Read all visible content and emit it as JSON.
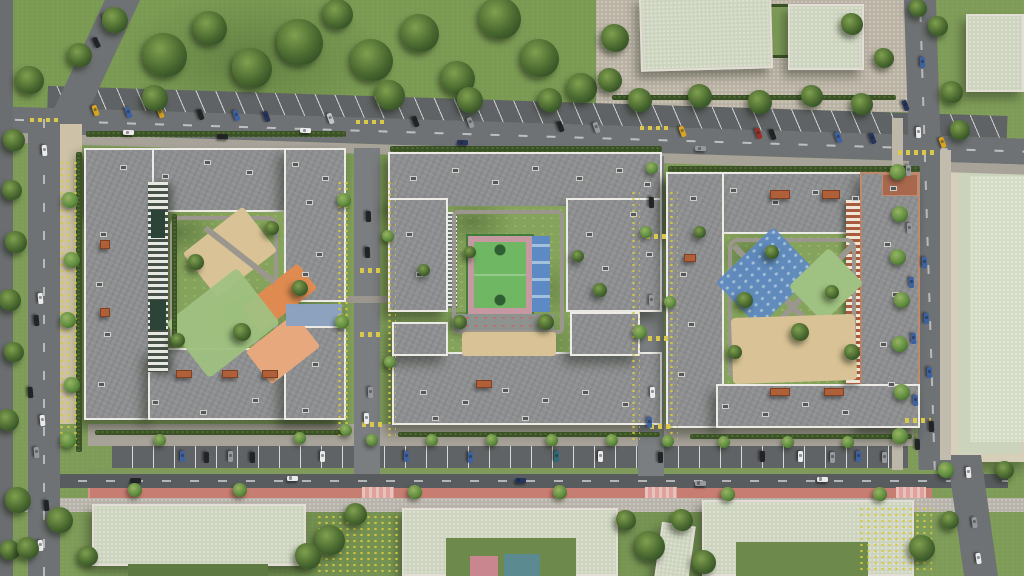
{
  "meta": {
    "title": "Aerial render of residential complex with three courtyard apartment blocks, playgrounds, sports court, roads and parking",
    "width": 1024,
    "height": 576
  },
  "palette": {
    "lawn": "#7e9c58",
    "yard": "#85a35c",
    "park": "#7a9a52",
    "treed": "#2e4a24",
    "tree": "#49682f",
    "treehi": "#7fa04f",
    "asphalt": "#6f7274",
    "asphaltd": "#595c5e",
    "street": "#7b7e80",
    "parkingc": "#606365",
    "path": "#9b978e",
    "sidewalk": "#a8a399",
    "plaza": "#b9b1a2",
    "tanpath": "#cdc2a8",
    "walkb": "#b7b3a9",
    "roof": "#8e8f91",
    "parapet": "#edebe5",
    "paleroof": "#ccd3bd",
    "palewall": "#e2ddd5",
    "sand": "#d9c396",
    "orange": "#df8a50",
    "salmon": "#e7a87e",
    "playgreen": "#9fc181",
    "courtg": "#6fb763",
    "courtgd": "#3f7d3c",
    "track": "#c698a2",
    "courtb": "#5d89c4",
    "courtbl": "#a3c1dc",
    "bluepad": "#8ca2bf",
    "bike": "#c87d72",
    "brick": "#ae5a3c",
    "hedge": "#3a5226",
    "flower": "#d6c93e",
    "yellow": "#d9c94a",
    "pinkcross": "#dfa29a",
    "cars": {
      "w": "#ebebeb",
      "k": "#222426",
      "g": "#97999c",
      "s": "#c4c6c8",
      "b": "#3d62a2",
      "n": "#27355c",
      "r": "#9c3028",
      "y": "#d9a422",
      "t": "#2e6b78"
    }
  },
  "scene": {
    "trees": [
      [
        165,
        55,
        22,
        0
      ],
      [
        210,
        28,
        17,
        0
      ],
      [
        252,
        68,
        20,
        0
      ],
      [
        300,
        42,
        23,
        0
      ],
      [
        338,
        14,
        15,
        0
      ],
      [
        372,
        60,
        21,
        0
      ],
      [
        420,
        33,
        19,
        0
      ],
      [
        458,
        78,
        17,
        0
      ],
      [
        500,
        18,
        21,
        0
      ],
      [
        540,
        58,
        19,
        0
      ],
      [
        582,
        88,
        15,
        0
      ],
      [
        615,
        38,
        14,
        0
      ],
      [
        390,
        95,
        15,
        0
      ],
      [
        470,
        100,
        13,
        0
      ],
      [
        155,
        98,
        13,
        0
      ],
      [
        115,
        20,
        13,
        0
      ],
      [
        80,
        55,
        12,
        0
      ],
      [
        30,
        80,
        14,
        0
      ],
      [
        14,
        140,
        11,
        0
      ],
      [
        550,
        100,
        12,
        0
      ],
      [
        610,
        80,
        12,
        0
      ],
      [
        640,
        100,
        12,
        0
      ],
      [
        700,
        96,
        12,
        0
      ],
      [
        760,
        102,
        12,
        0
      ],
      [
        812,
        96,
        11,
        0
      ],
      [
        862,
        104,
        11,
        0
      ],
      [
        12,
        190,
        10,
        0
      ],
      [
        16,
        242,
        11,
        0
      ],
      [
        10,
        300,
        11,
        0
      ],
      [
        14,
        352,
        10,
        0
      ],
      [
        8,
        420,
        11,
        0
      ],
      [
        18,
        500,
        13,
        0
      ],
      [
        10,
        550,
        10,
        0
      ],
      [
        70,
        200,
        8,
        1
      ],
      [
        72,
        260,
        8,
        1
      ],
      [
        68,
        320,
        8,
        1
      ],
      [
        72,
        385,
        8,
        1
      ],
      [
        68,
        440,
        8,
        1
      ],
      [
        852,
        24,
        11,
        0
      ],
      [
        884,
        58,
        10,
        0
      ],
      [
        938,
        26,
        10,
        0
      ],
      [
        952,
        92,
        11,
        0
      ],
      [
        918,
        8,
        9,
        0
      ],
      [
        960,
        130,
        10,
        0
      ],
      [
        898,
        172,
        8,
        1
      ],
      [
        900,
        214,
        8,
        1
      ],
      [
        898,
        257,
        8,
        1
      ],
      [
        902,
        300,
        8,
        1
      ],
      [
        900,
        344,
        8,
        1
      ],
      [
        902,
        392,
        8,
        1
      ],
      [
        900,
        436,
        8,
        1
      ],
      [
        946,
        470,
        8,
        1
      ],
      [
        950,
        520,
        9,
        0
      ],
      [
        1005,
        470,
        9,
        0
      ],
      [
        330,
        540,
        15,
        0
      ],
      [
        356,
        514,
        11,
        0
      ],
      [
        308,
        556,
        13,
        0
      ],
      [
        650,
        546,
        15,
        0
      ],
      [
        682,
        520,
        11,
        0
      ],
      [
        626,
        520,
        10,
        0
      ],
      [
        704,
        562,
        12,
        0
      ],
      [
        922,
        548,
        13,
        0
      ],
      [
        60,
        520,
        13,
        0
      ],
      [
        28,
        548,
        11,
        0
      ],
      [
        88,
        556,
        10,
        0
      ],
      [
        135,
        490,
        7,
        1
      ],
      [
        240,
        490,
        7,
        1
      ],
      [
        415,
        492,
        7,
        1
      ],
      [
        560,
        492,
        7,
        1
      ],
      [
        728,
        494,
        7,
        1
      ],
      [
        880,
        494,
        7,
        1
      ],
      [
        160,
        440,
        6,
        1
      ],
      [
        300,
        438,
        6,
        1
      ],
      [
        372,
        440,
        6,
        1
      ],
      [
        432,
        440,
        6,
        1
      ],
      [
        492,
        440,
        6,
        1
      ],
      [
        552,
        440,
        6,
        1
      ],
      [
        612,
        440,
        6,
        1
      ],
      [
        668,
        441,
        6,
        1
      ],
      [
        724,
        442,
        6,
        1
      ],
      [
        788,
        442,
        6,
        1
      ],
      [
        848,
        442,
        6,
        1
      ],
      [
        196,
        262,
        8,
        0
      ],
      [
        242,
        332,
        9,
        0
      ],
      [
        300,
        288,
        8,
        0
      ],
      [
        272,
        228,
        7,
        0
      ],
      [
        178,
        340,
        7,
        0
      ],
      [
        460,
        322,
        7,
        0
      ],
      [
        546,
        322,
        8,
        0
      ],
      [
        470,
        252,
        6,
        0
      ],
      [
        600,
        290,
        7,
        0
      ],
      [
        424,
        270,
        6,
        0
      ],
      [
        578,
        256,
        6,
        0
      ],
      [
        745,
        300,
        8,
        0
      ],
      [
        800,
        332,
        9,
        0
      ],
      [
        832,
        292,
        7,
        0
      ],
      [
        772,
        252,
        7,
        0
      ],
      [
        852,
        352,
        8,
        0
      ],
      [
        700,
        232,
        6,
        0
      ],
      [
        735,
        352,
        7,
        0
      ],
      [
        344,
        200,
        7,
        1
      ],
      [
        388,
        236,
        6,
        1
      ],
      [
        342,
        322,
        7,
        1
      ],
      [
        390,
        362,
        6,
        1
      ],
      [
        646,
        232,
        6,
        1
      ],
      [
        640,
        332,
        7,
        1
      ],
      [
        670,
        302,
        6,
        1
      ],
      [
        346,
        430,
        6,
        1
      ],
      [
        652,
        168,
        6,
        1
      ]
    ],
    "cars": [
      [
        95,
        110,
        70,
        "y"
      ],
      [
        128,
        112,
        70,
        "b"
      ],
      [
        160,
        112,
        70,
        "y"
      ],
      [
        200,
        114,
        70,
        "k"
      ],
      [
        236,
        115,
        70,
        "b"
      ],
      [
        266,
        116,
        70,
        "n"
      ],
      [
        330,
        118,
        70,
        "s"
      ],
      [
        415,
        121,
        70,
        "k"
      ],
      [
        470,
        122,
        70,
        "g"
      ],
      [
        560,
        126,
        70,
        "k"
      ],
      [
        596,
        127,
        70,
        "g"
      ],
      [
        682,
        131,
        70,
        "y"
      ],
      [
        758,
        133,
        70,
        "r"
      ],
      [
        772,
        134,
        70,
        "k"
      ],
      [
        838,
        137,
        70,
        "b"
      ],
      [
        872,
        138,
        70,
        "n"
      ],
      [
        942,
        142,
        70,
        "y"
      ],
      [
        128,
        132,
        2,
        "w"
      ],
      [
        222,
        136,
        2,
        "k"
      ],
      [
        305,
        130,
        2,
        "w"
      ],
      [
        462,
        142,
        2,
        "n"
      ],
      [
        700,
        148,
        2,
        "g"
      ],
      [
        135,
        480,
        0,
        "k"
      ],
      [
        292,
        478,
        0,
        "w"
      ],
      [
        520,
        480,
        0,
        "n"
      ],
      [
        822,
        479,
        0,
        "w"
      ],
      [
        700,
        483,
        0,
        "g"
      ],
      [
        182,
        456,
        90,
        "b"
      ],
      [
        206,
        457,
        90,
        "k"
      ],
      [
        230,
        456,
        90,
        "g"
      ],
      [
        252,
        457,
        90,
        "k"
      ],
      [
        322,
        456,
        90,
        "w"
      ],
      [
        406,
        456,
        90,
        "b"
      ],
      [
        470,
        457,
        90,
        "b"
      ],
      [
        556,
        456,
        90,
        "t"
      ],
      [
        600,
        456,
        90,
        "w"
      ],
      [
        660,
        457,
        90,
        "k"
      ],
      [
        762,
        456,
        90,
        "k"
      ],
      [
        800,
        456,
        90,
        "w"
      ],
      [
        832,
        457,
        90,
        "g"
      ],
      [
        858,
        456,
        90,
        "b"
      ],
      [
        884,
        457,
        90,
        "g"
      ],
      [
        44,
        150,
        85,
        "w"
      ],
      [
        40,
        298,
        85,
        "w"
      ],
      [
        36,
        320,
        85,
        "k"
      ],
      [
        30,
        392,
        85,
        "k"
      ],
      [
        42,
        420,
        85,
        "w"
      ],
      [
        36,
        452,
        85,
        "g"
      ],
      [
        46,
        505,
        85,
        "k"
      ],
      [
        40,
        545,
        85,
        "w"
      ],
      [
        106,
        18,
        65,
        "w"
      ],
      [
        96,
        42,
        65,
        "k"
      ],
      [
        922,
        62,
        88,
        "b"
      ],
      [
        918,
        132,
        88,
        "w"
      ],
      [
        924,
        262,
        88,
        "b"
      ],
      [
        926,
        318,
        88,
        "b"
      ],
      [
        929,
        372,
        88,
        "b"
      ],
      [
        931,
        426,
        88,
        "k"
      ],
      [
        968,
        472,
        85,
        "w"
      ],
      [
        974,
        522,
        82,
        "g"
      ],
      [
        978,
        558,
        82,
        "w"
      ],
      [
        905,
        105,
        70,
        "n"
      ],
      [
        908,
        170,
        88,
        "g"
      ],
      [
        909,
        228,
        88,
        "g"
      ],
      [
        911,
        282,
        88,
        "b"
      ],
      [
        913,
        338,
        88,
        "b"
      ],
      [
        915,
        400,
        88,
        "b"
      ],
      [
        917,
        444,
        88,
        "k"
      ],
      [
        368,
        216,
        88,
        "k"
      ],
      [
        367,
        252,
        88,
        "k"
      ],
      [
        370,
        392,
        88,
        "g"
      ],
      [
        366,
        418,
        88,
        "w"
      ],
      [
        651,
        202,
        88,
        "k"
      ],
      [
        652,
        392,
        88,
        "w"
      ],
      [
        649,
        422,
        88,
        "b"
      ],
      [
        651,
        300,
        88,
        "g"
      ]
    ],
    "vents": [
      [
        120,
        165
      ],
      [
        162,
        174
      ],
      [
        204,
        160
      ],
      [
        246,
        170
      ],
      [
        292,
        162
      ],
      [
        322,
        176
      ],
      [
        100,
        232
      ],
      [
        96,
        282
      ],
      [
        104,
        332
      ],
      [
        98,
        382
      ],
      [
        152,
        400
      ],
      [
        200,
        410
      ],
      [
        252,
        398
      ],
      [
        302,
        408
      ],
      [
        306,
        200
      ],
      [
        316,
        252
      ],
      [
        302,
        272
      ],
      [
        312,
        362
      ],
      [
        410,
        176
      ],
      [
        452,
        168
      ],
      [
        492,
        180
      ],
      [
        532,
        166
      ],
      [
        576,
        176
      ],
      [
        616,
        168
      ],
      [
        644,
        182
      ],
      [
        406,
        232
      ],
      [
        416,
        272
      ],
      [
        586,
        232
      ],
      [
        602,
        266
      ],
      [
        630,
        212
      ],
      [
        646,
        252
      ],
      [
        420,
        390
      ],
      [
        462,
        400
      ],
      [
        502,
        388
      ],
      [
        542,
        398
      ],
      [
        582,
        390
      ],
      [
        622,
        402
      ],
      [
        432,
        416
      ],
      [
        522,
        416
      ],
      [
        690,
        196
      ],
      [
        730,
        188
      ],
      [
        772,
        200
      ],
      [
        812,
        190
      ],
      [
        852,
        196
      ],
      [
        890,
        186
      ],
      [
        680,
        272
      ],
      [
        688,
        322
      ],
      [
        678,
        372
      ],
      [
        722,
        404
      ],
      [
        762,
        412
      ],
      [
        802,
        402
      ],
      [
        842,
        410
      ],
      [
        884,
        242
      ],
      [
        892,
        292
      ],
      [
        880,
        342
      ],
      [
        888,
        382
      ]
    ],
    "hedges": [
      [
        86,
        131,
        260,
        6
      ],
      [
        390,
        146,
        272,
        6
      ],
      [
        668,
        166,
        252,
        6
      ],
      [
        95,
        430,
        250,
        5
      ],
      [
        398,
        432,
        262,
        5
      ],
      [
        690,
        434,
        222,
        5
      ],
      [
        76,
        152,
        6,
        300
      ],
      [
        612,
        95,
        284,
        5
      ],
      [
        172,
        214,
        5,
        130
      ]
    ],
    "canopies": [
      [
        100,
        240,
        10,
        9
      ],
      [
        100,
        308,
        10,
        9
      ],
      [
        176,
        370,
        16,
        8
      ],
      [
        222,
        370,
        16,
        8
      ],
      [
        262,
        370,
        16,
        8
      ],
      [
        476,
        380,
        16,
        8
      ],
      [
        770,
        190,
        20,
        9
      ],
      [
        822,
        190,
        18,
        9
      ],
      [
        684,
        254,
        12,
        8
      ],
      [
        770,
        388,
        20,
        8
      ],
      [
        824,
        388,
        20,
        8
      ]
    ],
    "marks": [
      [
        356,
        120,
        30,
        4,
        "yellow"
      ],
      [
        640,
        126,
        30,
        4,
        "yellow"
      ],
      [
        898,
        150,
        36,
        5,
        "yellow"
      ],
      [
        30,
        118,
        30,
        4,
        "yellow"
      ],
      [
        360,
        268,
        20,
        5,
        "yellow"
      ],
      [
        360,
        332,
        20,
        5,
        "yellow"
      ],
      [
        362,
        422,
        20,
        5,
        "yellow"
      ],
      [
        646,
        234,
        20,
        5,
        "yellow"
      ],
      [
        648,
        336,
        20,
        5,
        "yellow"
      ],
      [
        650,
        424,
        20,
        5,
        "yellow"
      ],
      [
        905,
        418,
        26,
        5,
        "yellow"
      ],
      [
        362,
        487,
        32,
        11,
        "pinkcross"
      ],
      [
        645,
        487,
        32,
        11,
        "pinkcross"
      ],
      [
        896,
        487,
        30,
        11,
        "pinkcross"
      ]
    ],
    "flowers": [
      [
        316,
        514,
        84,
        58
      ],
      [
        858,
        506,
        74,
        64
      ],
      [
        58,
        160,
        22,
        290
      ],
      [
        336,
        180,
        12,
        256
      ],
      [
        386,
        180,
        10,
        256
      ],
      [
        630,
        190,
        10,
        250
      ],
      [
        668,
        190,
        10,
        250
      ]
    ]
  }
}
